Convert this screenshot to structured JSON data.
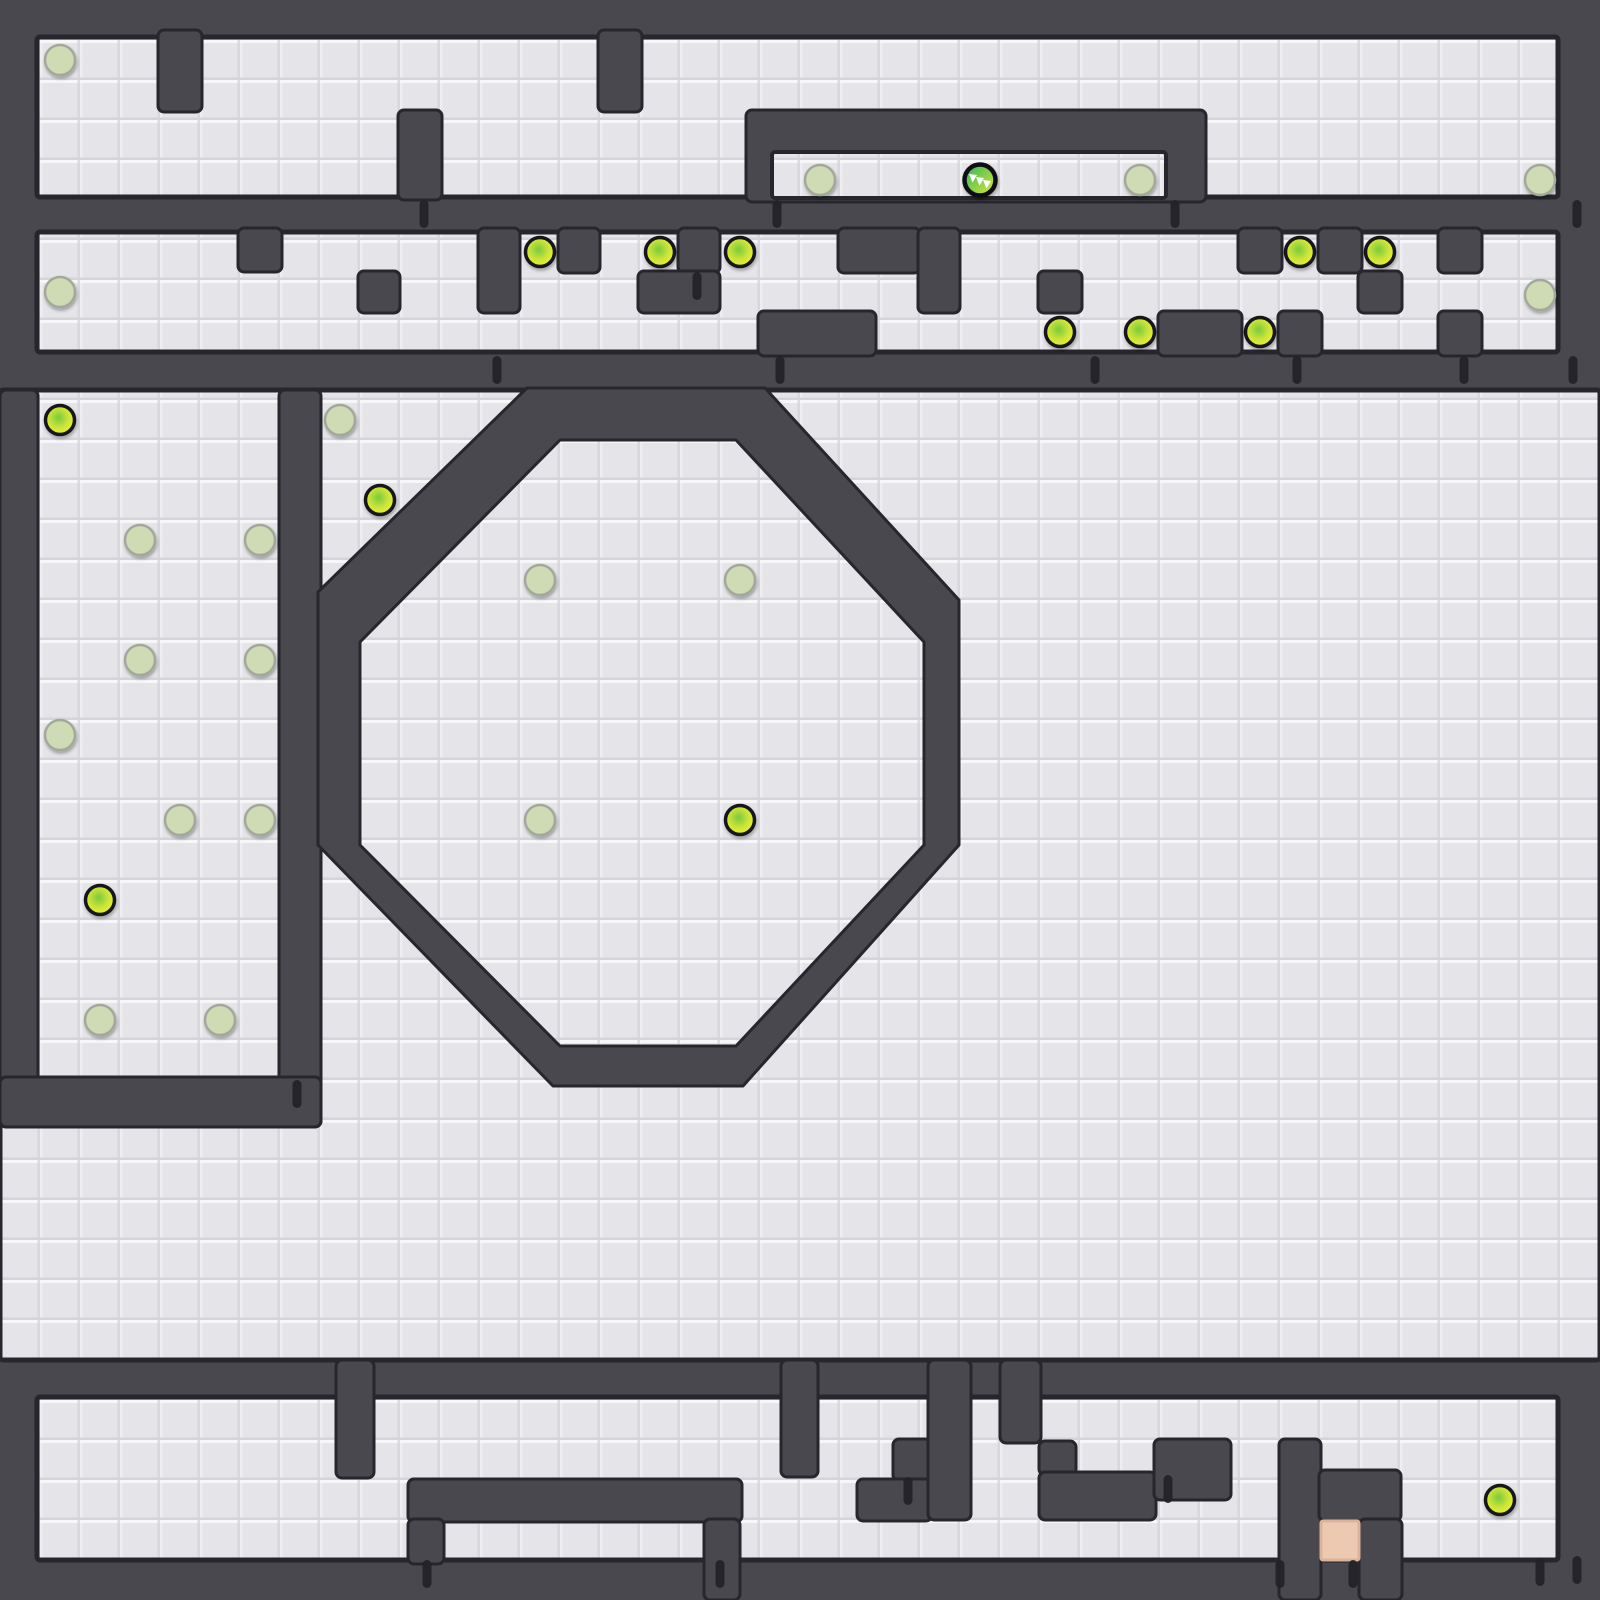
{
  "board": {
    "width": 1600,
    "height": 1600,
    "tile_size": 40,
    "colors": {
      "wall": "#48484e",
      "wall_lip": "#26262c",
      "tile_base": "#e5e4e8",
      "tile_hi": "#f7f6f9",
      "tile_lo": "#d5d4da",
      "peg": "#222227",
      "pellet_ring": "#17181c",
      "pellet_grad": [
        "#79ca41",
        "#cbe437",
        "#edf22b"
      ],
      "eaten_fill": "#cedbb5",
      "eaten_ring": "#a3a99a",
      "head_grad": [
        "#2fb362",
        "#dcea33"
      ],
      "head_ring": "#0e0f12",
      "fang": "#ffffff",
      "exit_fill": "#eec9b2",
      "exit_ring": "#dcb29a"
    },
    "floors": [
      [
        37,
        37,
        1521,
        160
      ],
      [
        37,
        232,
        1521,
        120
      ],
      [
        0,
        390,
        1600,
        970
      ],
      [
        37,
        1397,
        1521,
        163
      ]
    ],
    "overlay_floors": [
      [
        772,
        152,
        394,
        46
      ]
    ],
    "wall_blocks": [
      [
        158,
        30,
        44,
        82
      ],
      [
        398,
        110,
        44,
        90
      ],
      [
        598,
        30,
        44,
        82
      ],
      [
        746,
        110,
        460,
        92
      ],
      [
        238,
        228,
        44,
        44
      ],
      [
        358,
        271,
        42,
        42
      ],
      [
        478,
        228,
        42,
        85
      ],
      [
        558,
        228,
        42,
        45
      ],
      [
        678,
        228,
        42,
        45
      ],
      [
        638,
        271,
        82,
        42
      ],
      [
        758,
        311,
        118,
        45
      ],
      [
        838,
        228,
        82,
        45
      ],
      [
        918,
        228,
        42,
        85
      ],
      [
        1038,
        271,
        44,
        42
      ],
      [
        1238,
        228,
        44,
        45
      ],
      [
        1318,
        228,
        44,
        45
      ],
      [
        1438,
        228,
        44,
        45
      ],
      [
        1358,
        271,
        44,
        42
      ],
      [
        1158,
        311,
        84,
        45
      ],
      [
        1278,
        311,
        44,
        45
      ],
      [
        1438,
        311,
        44,
        45
      ],
      [
        0,
        390,
        38,
        737
      ],
      [
        279,
        390,
        42,
        737
      ],
      [
        0,
        1077,
        321,
        50
      ],
      [
        336,
        1360,
        38,
        118
      ],
      [
        408,
        1479,
        334,
        43
      ],
      [
        408,
        1519,
        36,
        45
      ],
      [
        704,
        1519,
        36,
        81
      ],
      [
        781,
        1360,
        37,
        117
      ],
      [
        893,
        1439,
        38,
        42
      ],
      [
        857,
        1479,
        75,
        42
      ],
      [
        928,
        1360,
        43,
        160
      ],
      [
        1000,
        1360,
        41,
        83
      ],
      [
        1039,
        1441,
        37,
        34
      ],
      [
        1039,
        1472,
        117,
        48
      ],
      [
        1154,
        1439,
        77,
        61
      ],
      [
        1279,
        1439,
        42,
        161
      ],
      [
        1319,
        1470,
        82,
        51
      ],
      [
        1359,
        1519,
        43,
        81
      ]
    ],
    "octagon": {
      "outer": [
        [
          527,
          388
        ],
        [
          765,
          388
        ],
        [
          959,
          600
        ],
        [
          959,
          845
        ],
        [
          743,
          1086
        ],
        [
          553,
          1086
        ],
        [
          318,
          845
        ],
        [
          318,
          592
        ]
      ],
      "inner": [
        [
          560,
          440
        ],
        [
          736,
          440
        ],
        [
          924,
          642
        ],
        [
          924,
          845
        ],
        [
          736,
          1046
        ],
        [
          560,
          1046
        ],
        [
          360,
          845
        ],
        [
          360,
          642
        ]
      ]
    },
    "pegs": [
      [
        424,
        200
      ],
      [
        777,
        200
      ],
      [
        1175,
        200
      ],
      [
        1577,
        200
      ],
      [
        697,
        272
      ],
      [
        497,
        356
      ],
      [
        780,
        356
      ],
      [
        1095,
        356
      ],
      [
        1297,
        356
      ],
      [
        1464,
        356
      ],
      [
        1573,
        356
      ],
      [
        297,
        1080
      ],
      [
        908,
        1477
      ],
      [
        1168,
        1475
      ],
      [
        427,
        1560
      ],
      [
        720,
        1560
      ],
      [
        1280,
        1560
      ],
      [
        1353,
        1560
      ],
      [
        1540,
        1558
      ],
      [
        1577,
        1556
      ]
    ],
    "pellets_fresh": [
      [
        540,
        252
      ],
      [
        660,
        252
      ],
      [
        740,
        252
      ],
      [
        1300,
        252
      ],
      [
        1380,
        252
      ],
      [
        1060,
        332
      ],
      [
        1140,
        332
      ],
      [
        1260,
        332
      ],
      [
        60,
        420
      ],
      [
        380,
        500
      ],
      [
        100,
        900
      ],
      [
        740,
        820
      ],
      [
        1500,
        1500
      ]
    ],
    "pellets_eaten": [
      [
        60,
        60
      ],
      [
        820,
        180
      ],
      [
        1140,
        180
      ],
      [
        1540,
        180
      ],
      [
        60,
        292
      ],
      [
        1540,
        295
      ],
      [
        340,
        420
      ],
      [
        140,
        540
      ],
      [
        260,
        540
      ],
      [
        140,
        660
      ],
      [
        260,
        660
      ],
      [
        60,
        735
      ],
      [
        180,
        820
      ],
      [
        260,
        820
      ],
      [
        100,
        1020
      ],
      [
        220,
        1020
      ],
      [
        540,
        580
      ],
      [
        740,
        580
      ],
      [
        540,
        820
      ]
    ],
    "player": {
      "x": 980,
      "y": 180,
      "r": 15.5,
      "fangs": [
        [
          -11,
          -6
        ],
        [
          -4,
          -3
        ],
        [
          3,
          0
        ]
      ]
    },
    "exit_tile": [
      1321,
      1521,
      38,
      39
    ]
  }
}
